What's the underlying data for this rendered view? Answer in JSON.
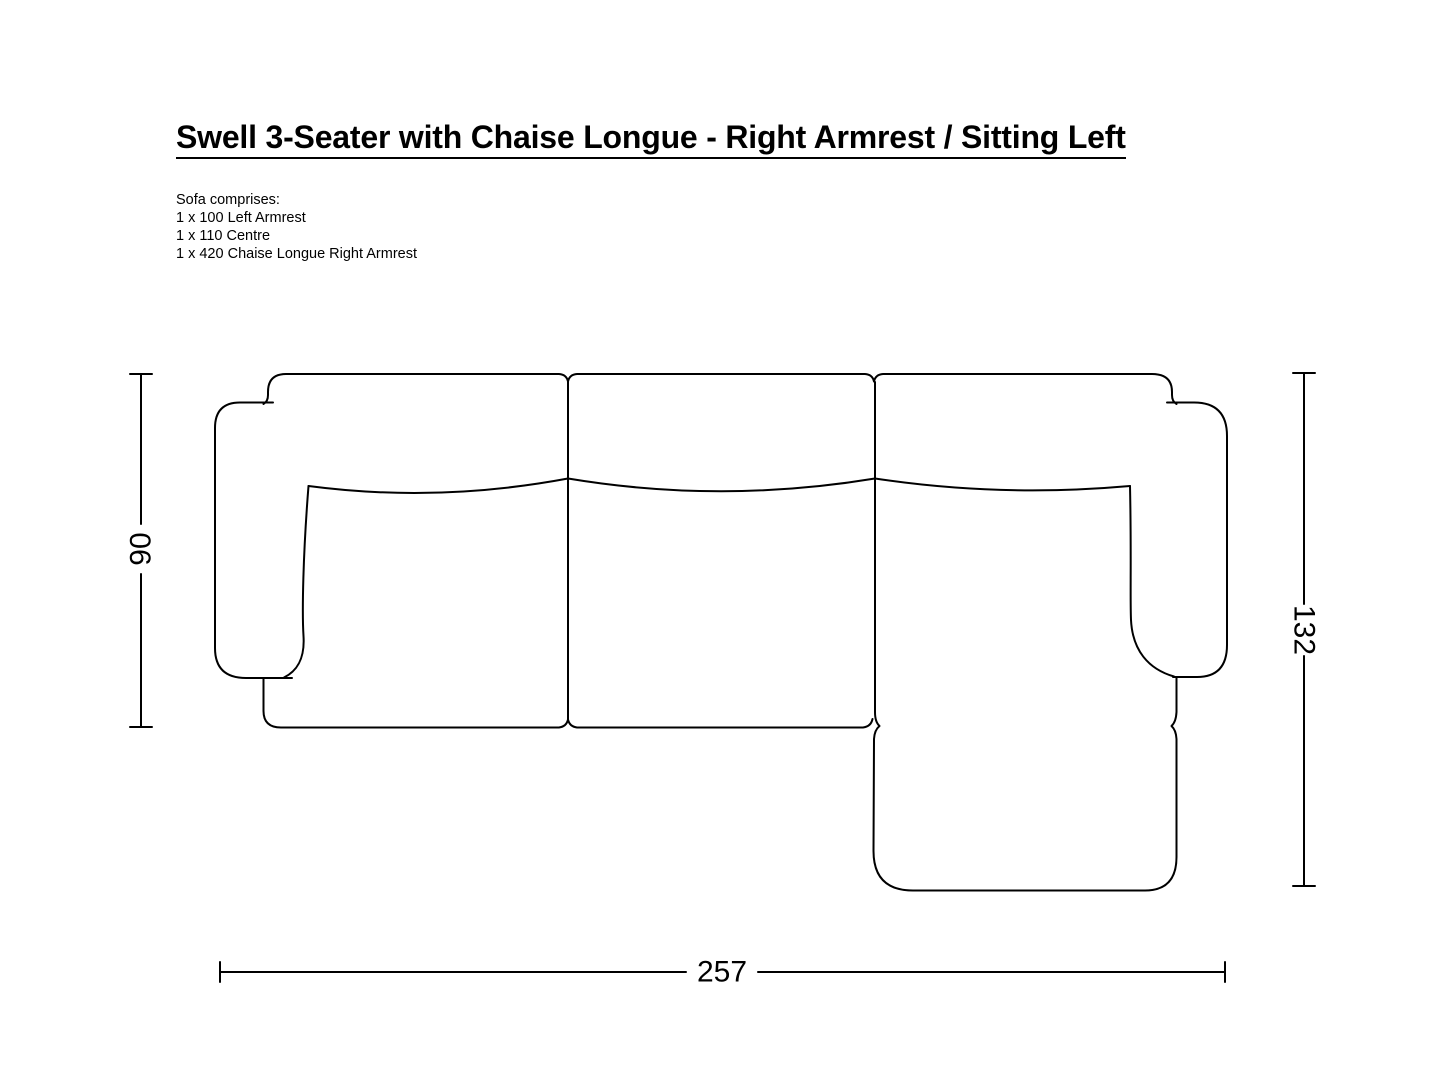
{
  "title": "Swell 3-Seater with Chaise Longue - Right Armrest / Sitting Left",
  "comprises": {
    "heading": "Sofa comprises:",
    "items": [
      "1 x 100 Left Armrest",
      "1 x 110 Centre",
      "1 x 420 Chaise Longue Right Armrest"
    ]
  },
  "dimensions": {
    "sofa_depth": "90",
    "chaise_depth": "132",
    "total_width": "257"
  },
  "colors": {
    "line": "#000000",
    "background": "#ffffff",
    "text": "#000000"
  }
}
